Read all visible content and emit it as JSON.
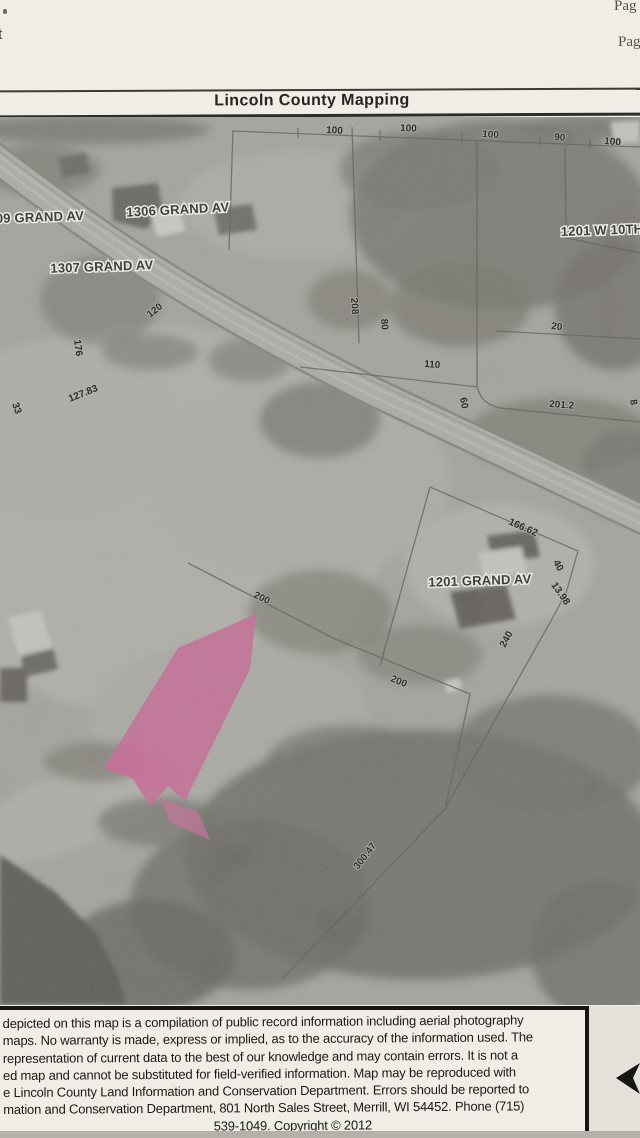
{
  "page": {
    "corner_fragments": {
      "top_left_char": "t",
      "page_edge_top": "Pag",
      "page_edge_bottom": "Pag"
    },
    "header": {
      "title": "Lincoln County Mapping"
    },
    "map": {
      "highlight_arrow_color": "#d8468f",
      "address_labels": [
        {
          "text": "09 GRAND AV",
          "x": -4,
          "y": 223,
          "rot": -2,
          "anchor": "start"
        },
        {
          "text": "1306 GRAND AV",
          "x": 178,
          "y": 214,
          "rot": -3,
          "anchor": "middle"
        },
        {
          "text": "1307 GRAND AV",
          "x": 102,
          "y": 271,
          "rot": -2,
          "anchor": "middle"
        },
        {
          "text": "1201 W 10TH",
          "x": 561,
          "y": 236,
          "rot": -2,
          "anchor": "start"
        },
        {
          "text": "1201 GRAND AV",
          "x": 480,
          "y": 585,
          "rot": -2,
          "anchor": "middle"
        }
      ],
      "dimension_labels": [
        {
          "text": "100",
          "x": 326,
          "y": 133,
          "rot": 3
        },
        {
          "text": "100",
          "x": 400,
          "y": 131,
          "rot": 2
        },
        {
          "text": "100",
          "x": 482,
          "y": 137,
          "rot": 4
        },
        {
          "text": "90",
          "x": 554,
          "y": 140,
          "rot": 5
        },
        {
          "text": "100",
          "x": 604,
          "y": 144,
          "rot": 5
        },
        {
          "text": "120",
          "x": 150,
          "y": 318,
          "rot": -38
        },
        {
          "text": "176",
          "x": 74,
          "y": 340,
          "rot": 82
        },
        {
          "text": "127.83",
          "x": 70,
          "y": 402,
          "rot": -22
        },
        {
          "text": "33",
          "x": 12,
          "y": 404,
          "rot": 70
        },
        {
          "text": "208",
          "x": 351,
          "y": 298,
          "rot": 86
        },
        {
          "text": "80",
          "x": 381,
          "y": 319,
          "rot": 86
        },
        {
          "text": "110",
          "x": 424,
          "y": 367,
          "rot": 4
        },
        {
          "text": "60",
          "x": 460,
          "y": 398,
          "rot": 80
        },
        {
          "text": "20",
          "x": 551,
          "y": 329,
          "rot": 6
        },
        {
          "text": "201.2",
          "x": 549,
          "y": 407,
          "rot": 4
        },
        {
          "text": "8",
          "x": 630,
          "y": 400,
          "rot": 80
        },
        {
          "text": "166.62",
          "x": 508,
          "y": 524,
          "rot": 24
        },
        {
          "text": "40",
          "x": 553,
          "y": 562,
          "rot": 62
        },
        {
          "text": "13.98",
          "x": 551,
          "y": 585,
          "rot": 55
        },
        {
          "text": "240",
          "x": 505,
          "y": 648,
          "rot": -62
        },
        {
          "text": "200",
          "x": 253,
          "y": 597,
          "rot": 26
        },
        {
          "text": "200",
          "x": 390,
          "y": 681,
          "rot": 22
        },
        {
          "text": "300.47",
          "x": 358,
          "y": 870,
          "rot": -52
        }
      ]
    },
    "disclaimer": {
      "lines": [
        "depicted on this map is a compilation of public record information including aerial photography",
        "maps. No warranty is made, express or implied, as to the accuracy of the information used. The",
        "representation of current data to the best of our knowledge and may contain errors. It is not a",
        "ed map and cannot be substituted for field-verified information. Map may be reproduced with",
        "e Lincoln County Land Information and Conservation Department. Errors should be reported to",
        "mation and Conservation Department, 801 North Sales Street, Merrill, WI 54452. Phone (715)",
        "539-1049. Copyright © 2012"
      ]
    }
  }
}
